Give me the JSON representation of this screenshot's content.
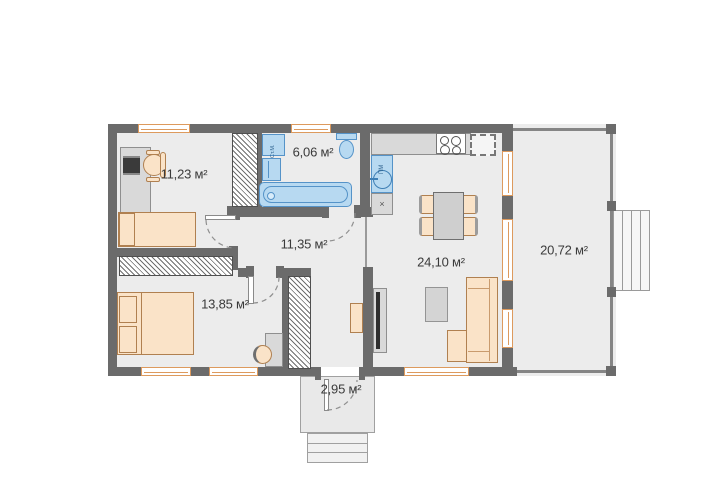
{
  "floor_plan": {
    "title": "single-storey house floor plan",
    "rooms": {
      "office": "11,23 м²",
      "bathroom": "6,06 м²",
      "hallway": "11,35 м²",
      "living_kitchen": "24,10 м²",
      "bedroom": "13,85 м²",
      "terrace": "20,72 м²",
      "porch": "2,95 м²"
    },
    "fixtures": {
      "washing_machine": "Ст.М.",
      "dishwasher": "ПМ",
      "kitchen_unit_mark": "×"
    },
    "colors": {
      "wall": "#6b6b6b",
      "floor": "#ececec",
      "window_accent": "#dd9a5d",
      "fixture_blue": "#b7d9f1",
      "furniture_peach": "#fae3c8",
      "furniture_gray": "#d9d9d9"
    }
  }
}
